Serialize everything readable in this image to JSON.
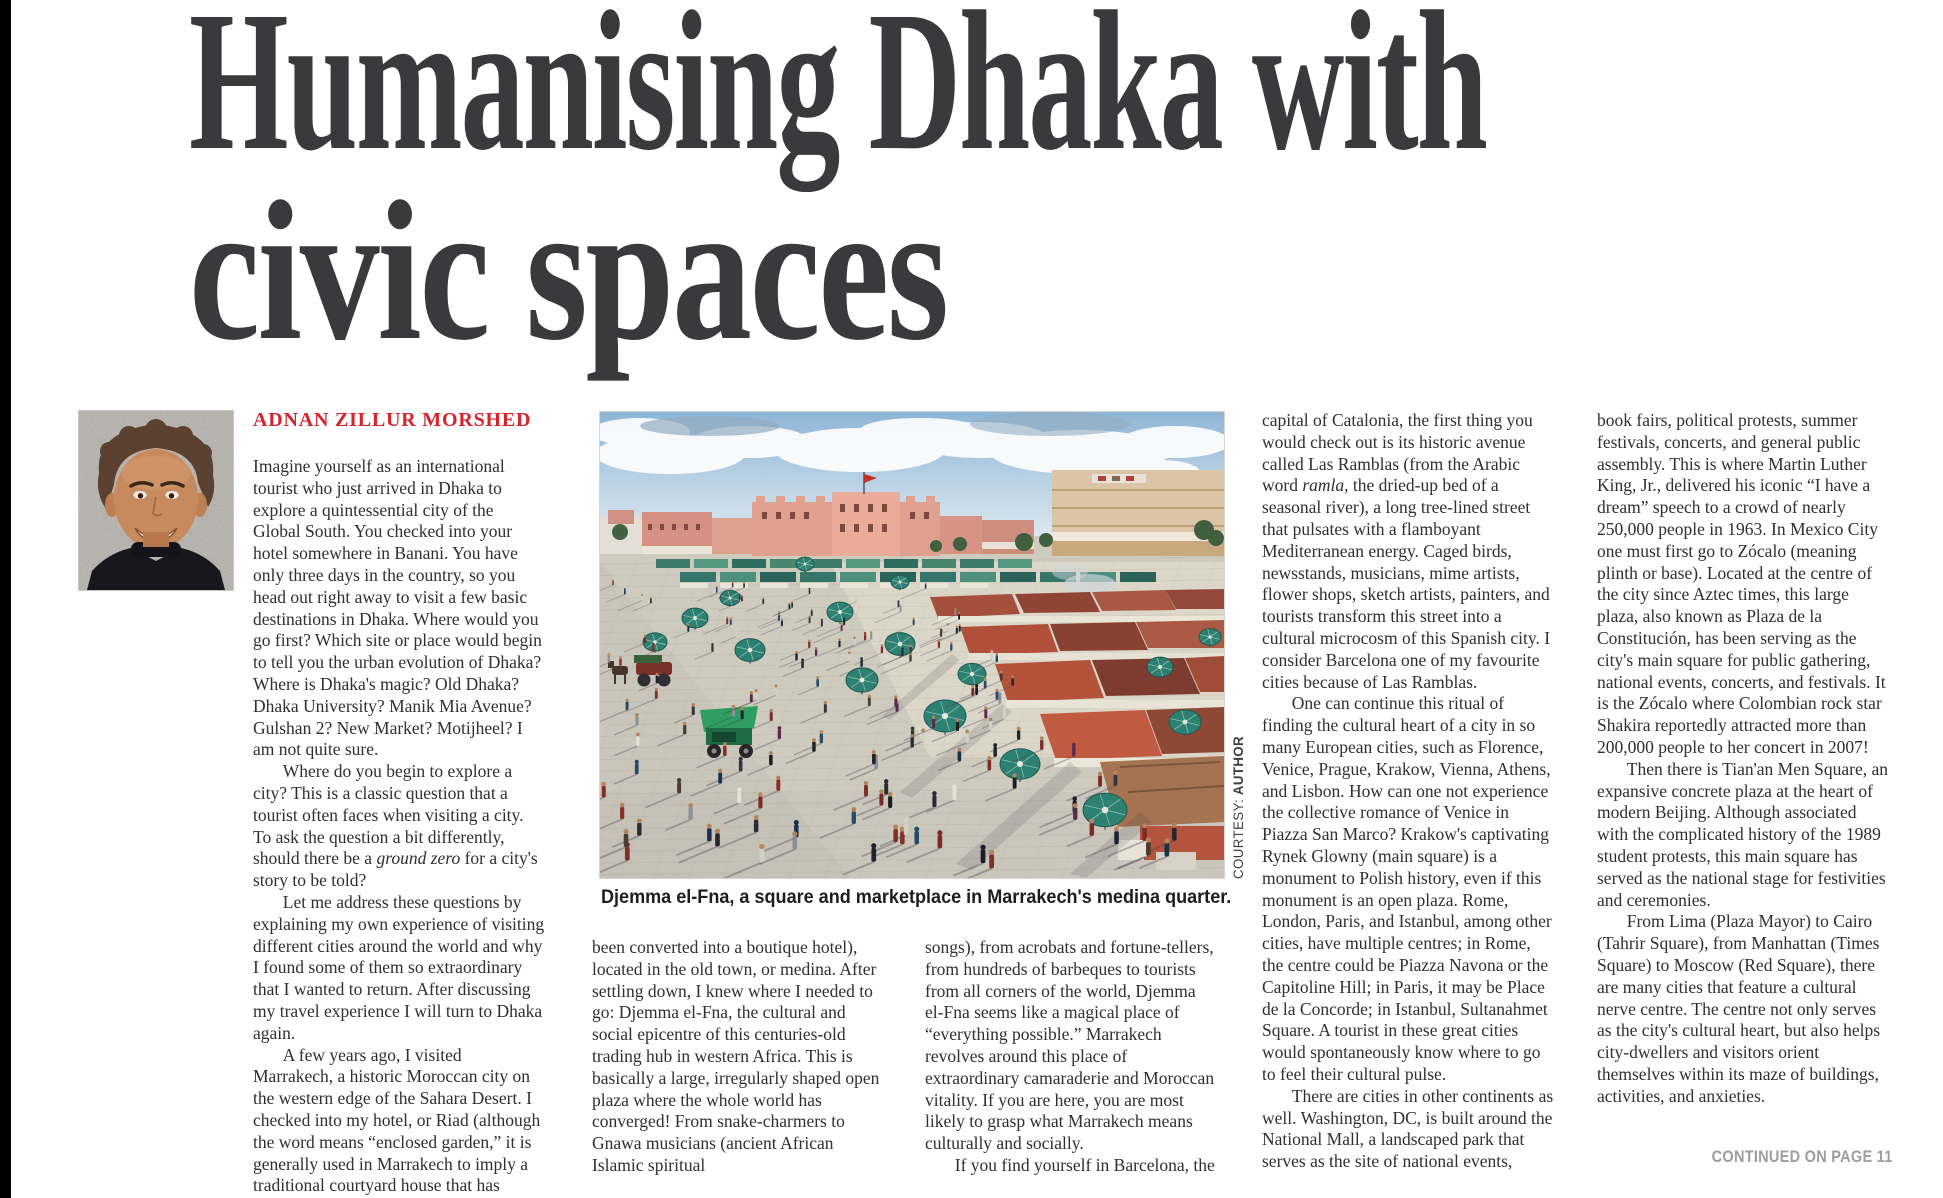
{
  "masthead": {
    "headline_line1": "Humanising Dhaka with",
    "headline_line2": "civic spaces"
  },
  "author": {
    "byline": "ADNAN ZILLUR MORSHED"
  },
  "photo": {
    "caption": "Djemma el-Fna, a square and marketplace in Marrakech's medina quarter.",
    "courtesy_label": "COURTESY:",
    "courtesy_value": "AUTHOR",
    "palette": {
      "sky_top": "#8fb6d6",
      "sky_bottom": "#dce8f0",
      "cloud": "#ffffff",
      "building_pink": "#e0a08e",
      "building_beige": "#dcc5a6",
      "awning_teal": "#3e7b6b",
      "stall_red": "#b0503a",
      "stall_brown": "#a5734f",
      "umbrella_teal": "#2d8173",
      "pavement": "#cfcabe",
      "person_skin": "#b5835c",
      "shadow_tint": "#474454"
    }
  },
  "article": {
    "col1": [
      "Imagine yourself as an international tourist who just arrived in Dhaka to explore a quintessential city of the Global South. You checked into your hotel somewhere in Banani. You have only three days in the country, so you head out right away to visit a few basic destinations in Dhaka. Where would you go first? Which site or place would begin to tell you the urban evolution of Dhaka? Where is Dhaka's magic? Old Dhaka? Dhaka University? Manik Mia Avenue? Gulshan 2? New Market? Motijheel? I am not quite sure.",
      "Where do you begin to explore a city? This is a classic question that a tourist often faces when visiting a city. To ask the question a bit differently, should there be a *ground zero* for a city's story to be told?",
      "Let me address these questions by explaining my own experience of visiting different cities around the world and why I found some of them so extraordinary that I wanted to return. After discussing my travel experience I will turn to Dhaka again.",
      "A few years ago, I visited Marrakech, a historic Moroccan city on the western edge of the Sahara Desert. I checked into my hotel, or Riad (although the word means “enclosed garden,” it is generally used in Marrakech to imply a traditional courtyard house that has"
    ],
    "col2": [
      "been converted into a boutique hotel), located in the old town, or medina. After settling down, I knew where I needed to go: Djemma el-Fna, the cultural and social epicentre of this centuries-old trading hub in western Africa. This is basically a large, irregularly shaped open plaza where the whole world has converged! From snake-charmers to Gnawa musicians (ancient African Islamic spiritual"
    ],
    "col3": [
      "songs), from acrobats and fortune-tellers, from hundreds of barbeques to tourists from all corners of the world, Djemma el-Fna seems like a magical place of “everything possible.” Marrakech revolves around this place of extraordinary camaraderie and Moroccan vitality. If you are here, you are most likely to grasp what Marrakech means culturally and socially.",
      "If you find yourself in Barcelona, the"
    ],
    "col4": [
      "capital of Catalonia, the first thing you would check out is its historic avenue called Las Ramblas (from the Arabic word *ramla*, the dried-up bed of a seasonal river), a long tree-lined street that pulsates with a flamboyant Mediterranean energy. Caged birds, newsstands, musicians, mime artists, flower shops, sketch artists, painters, and tourists transform this street into a cultural microcosm of this Spanish city. I consider Barcelona one of my favourite cities because of Las Ramblas.",
      "One can continue this ritual of finding the cultural heart of a city in so many European cities, such as Florence, Venice, Prague, Krakow, Vienna, Athens, and Lisbon. How can one not experience the collective romance of Venice in Piazza San Marco? Krakow's captivating Rynek Glowny (main square) is a monument to Polish history, even if this monument is an open plaza. Rome, London, Paris, and Istanbul, among other cities, have multiple centres; in Rome, the centre could be Piazza Navona or the Capitoline Hill; in Paris, it may be Place de la Concorde; in Istanbul, Sultanahmet Square. A tourist in these great cities would spontaneously know where to go to feel their cultural pulse.",
      "There are cities in other continents as well. Washington, DC, is built around the National Mall, a landscaped park that serves as the site of national events,"
    ],
    "col5": [
      "book fairs, political protests, summer festivals, concerts, and general public assembly. This is where Martin Luther King, Jr., delivered his iconic “I have a dream” speech to a crowd of nearly 250,000 people in 1963. In Mexico City one must first go to Zócalo (meaning plinth or base). Located at the centre of the city since Aztec times, this large plaza, also known as Plaza de la Constitución, has been serving as the city's main square for public gathering, national events, concerts, and festivals. It is the Zócalo where Colombian rock star Shakira reportedly attracted more than 200,000 people to her concert in 2007!",
      "Then there is Tian'an Men Square, an expansive concrete plaza at the heart of modern Beijing. Although associated with the complicated history of the 1989 student protests, this main square has served as the national stage for festivities and ceremonies.",
      "From Lima (Plaza Mayor) to Cairo (Tahrir Square), from Manhattan (Times Square) to Moscow (Red Square), there are many cities that feature a cultural nerve centre. The centre not only serves as the city's cultural heart, but also helps city-dwellers and visitors orient themselves within its maze of buildings, activities, and anxieties."
    ]
  },
  "footer": {
    "continued": "CONTINUED ON PAGE 11"
  }
}
